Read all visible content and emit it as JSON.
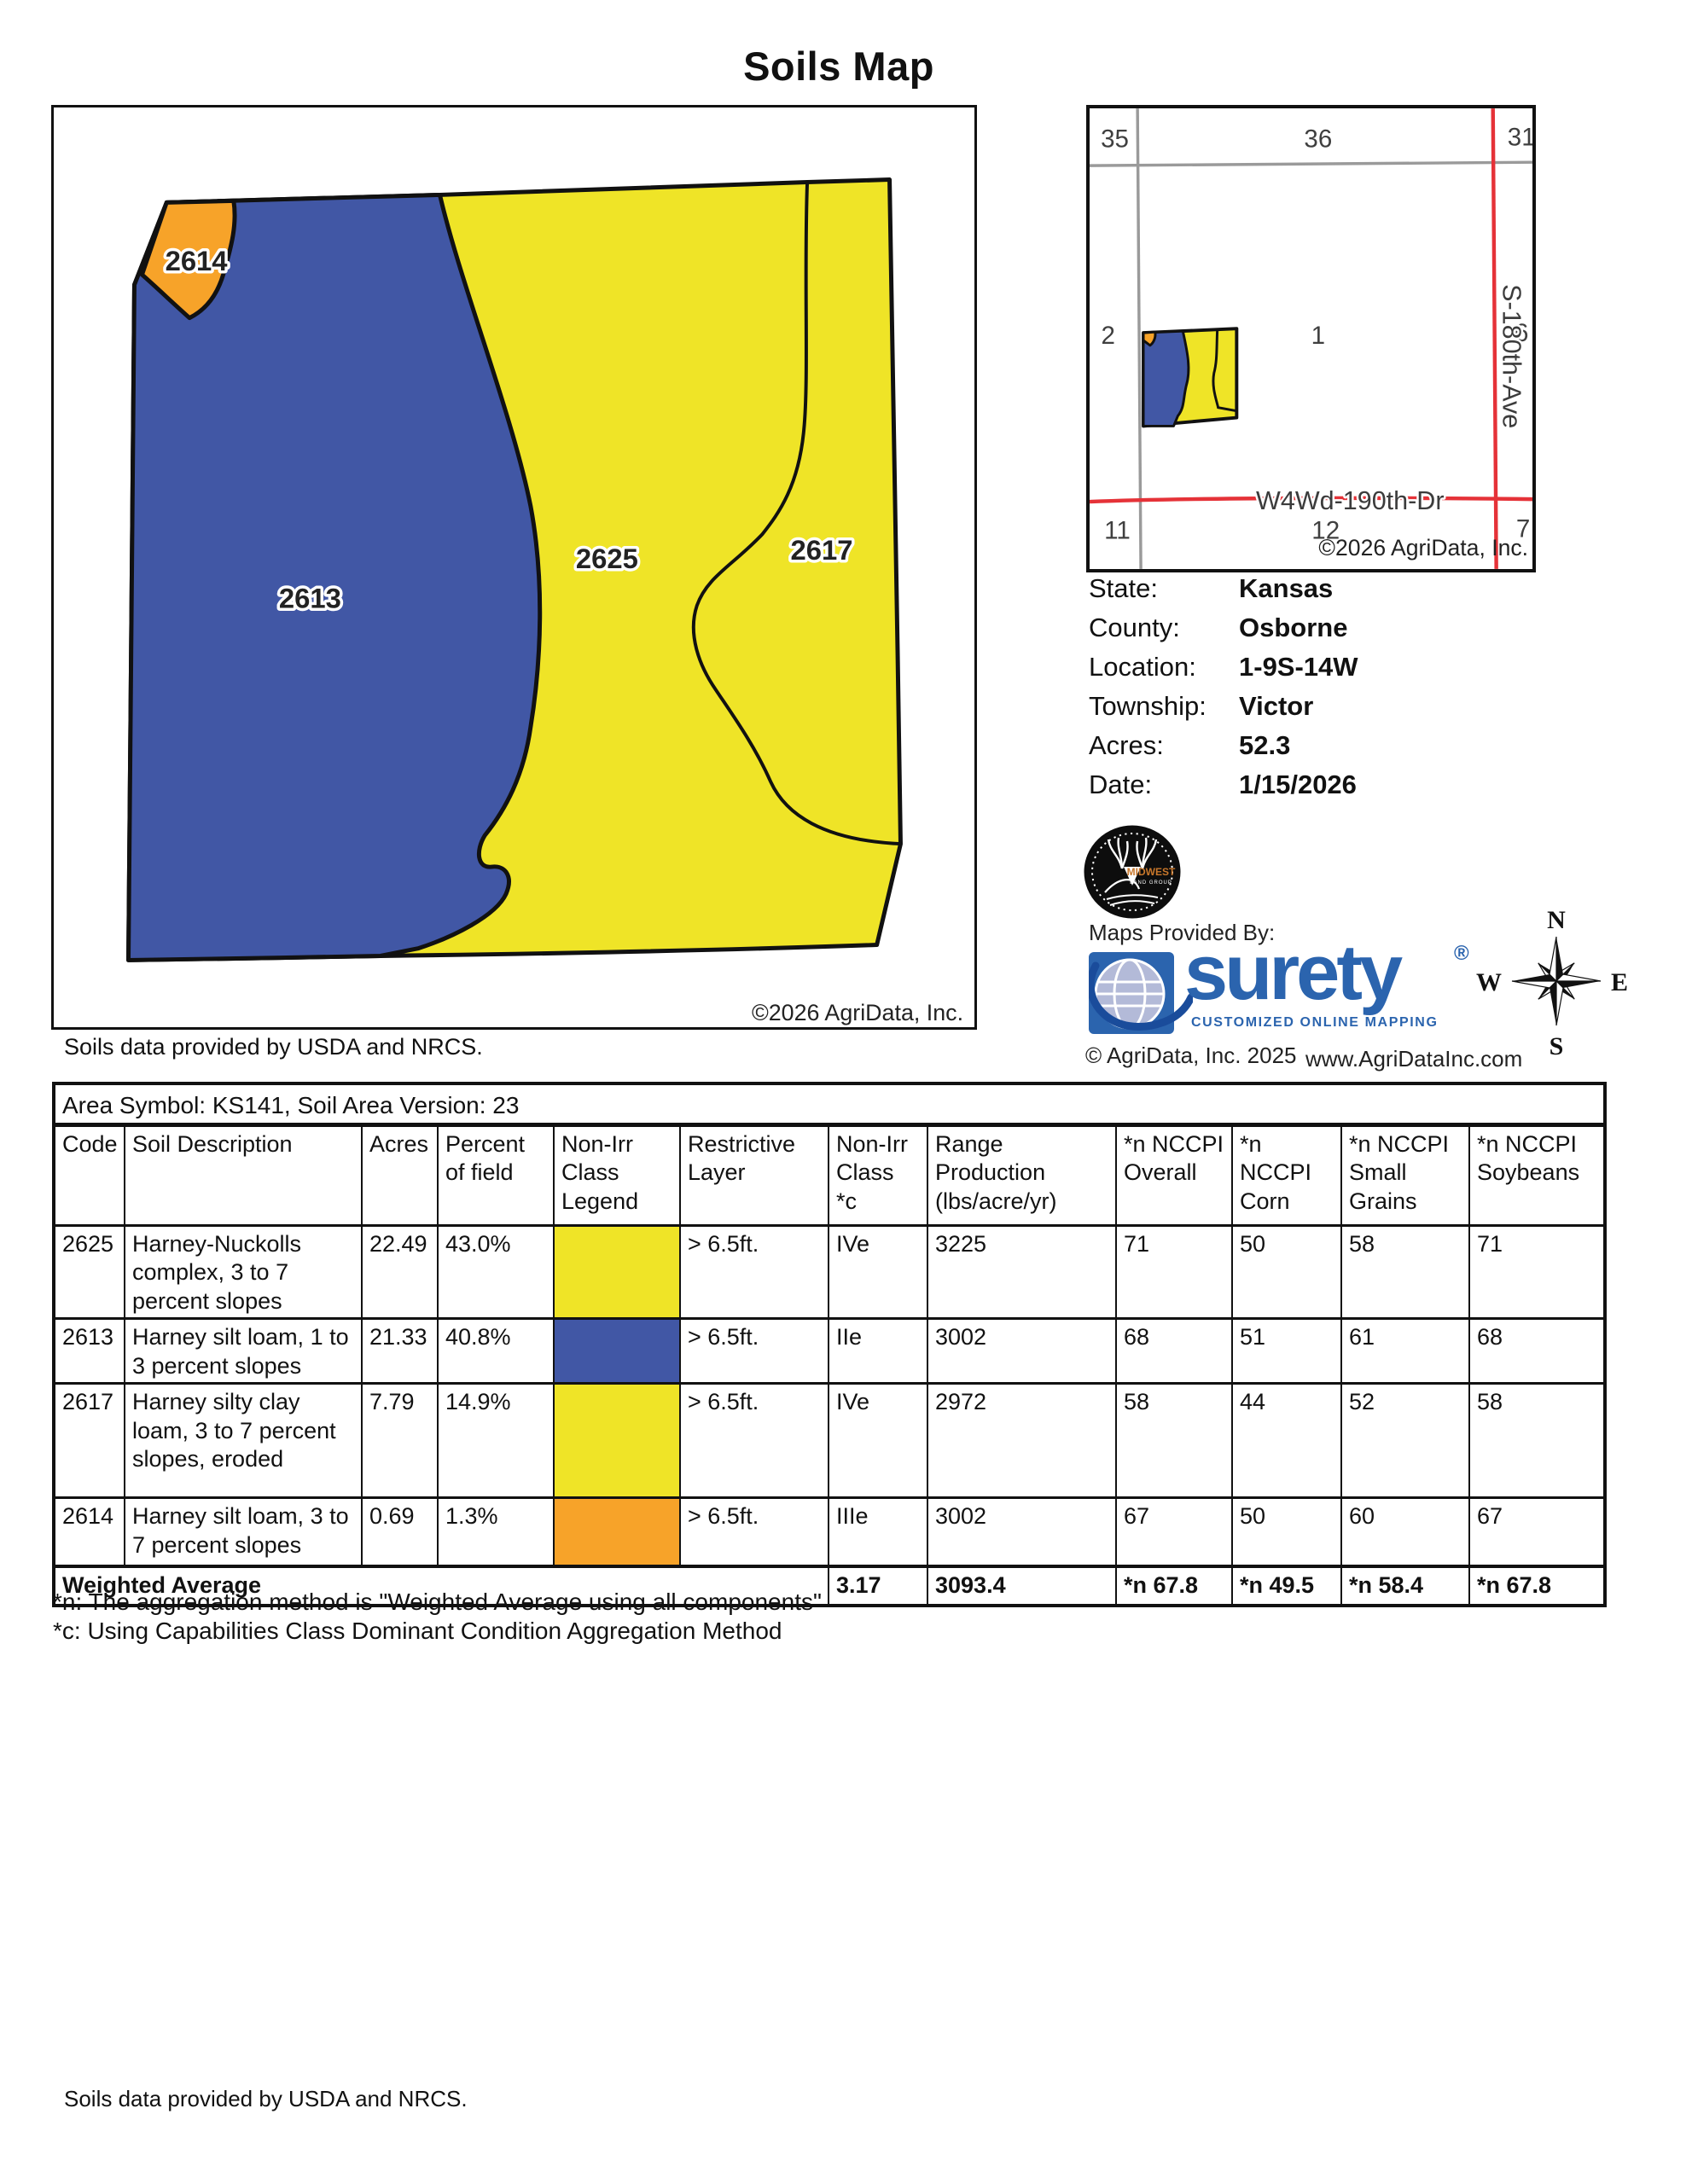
{
  "title": "Soils Map",
  "map": {
    "labels": {
      "l2613": "2613",
      "l2625": "2625",
      "l2617": "2617",
      "l2614": "2614"
    },
    "copyright": "©2026 AgriData, Inc.",
    "caption": "Soils data provided by USDA and NRCS."
  },
  "locator": {
    "sections": {
      "s35": "35",
      "s36": "36",
      "s31": "31",
      "s2": "2",
      "s1": "1",
      "s6": "6",
      "s11": "11",
      "s12": "12",
      "s7": "7"
    },
    "road_vertical": "S-180th-Ave",
    "road_horizontal": "W4Wd-190th-Dr",
    "copyright": "©2026 AgriData, Inc."
  },
  "info": {
    "rows": [
      {
        "label": "State:",
        "value": "Kansas"
      },
      {
        "label": "County:",
        "value": "Osborne"
      },
      {
        "label": "Location:",
        "value": "1-9S-14W"
      },
      {
        "label": "Township:",
        "value": "Victor"
      },
      {
        "label": "Acres:",
        "value": "52.3"
      },
      {
        "label": "Date:",
        "value": "1/15/2026"
      }
    ]
  },
  "provider": {
    "maps_provided_by": "Maps Provided By:",
    "brand": "surety",
    "reg": "®",
    "tagline": "CUSTOMIZED ONLINE MAPPING",
    "copyright": "© AgriData, Inc. 2025",
    "website": "www.AgriDataInc.com",
    "midwest_line1": "MIDWEST",
    "midwest_line2": "LAND GROUP"
  },
  "compass": {
    "n": "N",
    "e": "E",
    "s": "S",
    "w": "W"
  },
  "table": {
    "area_symbol": "Area Symbol: KS141, Soil Area Version: 23",
    "headers": [
      "Code",
      "Soil Description",
      "Acres",
      "Percent of field",
      "Non-Irr Class Legend",
      "Restrictive Layer",
      "Non-Irr Class *c",
      "Range Production (lbs/acre/yr)",
      "*n NCCPI Overall",
      "*n NCCPI Corn",
      "*n NCCPI Small Grains",
      "*n NCCPI Soybeans"
    ],
    "rows": [
      {
        "code": "2625",
        "description": "Harney-Nuckolls complex, 3 to 7 percent slopes",
        "acres": "22.49",
        "percent": "43.0%",
        "legend_color": "#EFE427",
        "restrictive": "> 6.5ft.",
        "nonirr_class": "IVe",
        "range_production": "3225",
        "nccpi_overall": "71",
        "nccpi_corn": "50",
        "nccpi_small_grains": "58",
        "nccpi_soybeans": "71"
      },
      {
        "code": "2613",
        "description": "Harney silt loam, 1 to 3 percent slopes",
        "acres": "21.33",
        "percent": "40.8%",
        "legend_color": "#4157A5",
        "restrictive": "> 6.5ft.",
        "nonirr_class": "IIe",
        "range_production": "3002",
        "nccpi_overall": "68",
        "nccpi_corn": "51",
        "nccpi_small_grains": "61",
        "nccpi_soybeans": "68"
      },
      {
        "code": "2617",
        "description": "Harney silty clay loam, 3 to 7 percent slopes, eroded",
        "acres": "7.79",
        "percent": "14.9%",
        "legend_color": "#EFE427",
        "restrictive": "> 6.5ft.",
        "nonirr_class": "IVe",
        "range_production": "2972",
        "nccpi_overall": "58",
        "nccpi_corn": "44",
        "nccpi_small_grains": "52",
        "nccpi_soybeans": "58"
      },
      {
        "code": "2614",
        "description": "Harney silt loam, 3 to 7 percent slopes",
        "acres": "0.69",
        "percent": "1.3%",
        "legend_color": "#F7A329",
        "restrictive": "> 6.5ft.",
        "nonirr_class": "IIIe",
        "range_production": "3002",
        "nccpi_overall": "67",
        "nccpi_corn": "50",
        "nccpi_small_grains": "60",
        "nccpi_soybeans": "67"
      }
    ],
    "weighted": {
      "label": "Weighted Average",
      "nonirr_class": "3.17",
      "range_production": "3093.4",
      "nccpi_overall": "*n 67.8",
      "nccpi_corn": "*n 49.5",
      "nccpi_small_grains": "*n 58.4",
      "nccpi_soybeans": "*n 67.8"
    }
  },
  "footnotes": {
    "n": "*n: The aggregation method is \"Weighted Average using all components\"",
    "c": "*c: Using Capabilities Class Dominant Condition Aggregation Method"
  },
  "footer": "Soils data provided by USDA and NRCS.",
  "colors": {
    "soil_yellow": "#EFE427",
    "soil_blue": "#4157A5",
    "soil_orange": "#F7A329",
    "road_red": "#E53238",
    "road_gray": "#9A9A9A",
    "surety_blue": "#2B64AE",
    "surety_globe": "#B3BAD8",
    "surety_swoosh": "#1A4C9B",
    "midwest_orange": "#C8772B"
  }
}
